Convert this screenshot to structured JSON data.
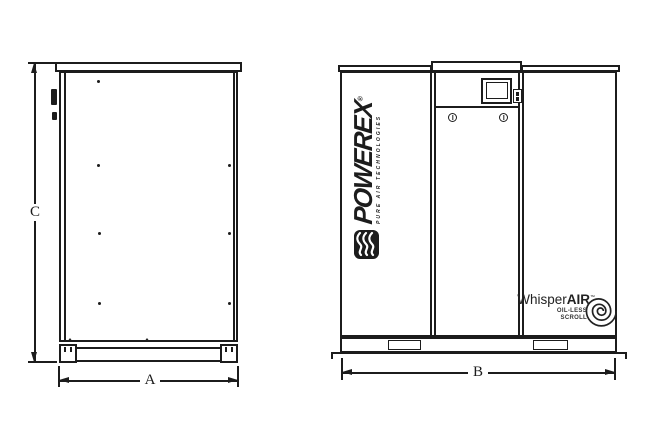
{
  "drawing": {
    "background": "#ffffff",
    "line_color": "#1c1c1c",
    "dim_a": "A",
    "dim_b": "B",
    "dim_c": "C",
    "powerex_wordmark": "POWEREX",
    "powerex_registered": "®",
    "powerex_tagline": "PURE AIR TECHNOLOGIES",
    "whisper_prefix": "Whisper",
    "whisper_suffix": "AIR",
    "whisper_trademark": "™",
    "whisper_subtitle_line1": "OIL-LESS",
    "whisper_subtitle_line2": "SCROLL",
    "icons": {
      "powerex_icon": "powerex-wave-icon",
      "scroll_icon": "scroll-spiral-icon"
    }
  }
}
